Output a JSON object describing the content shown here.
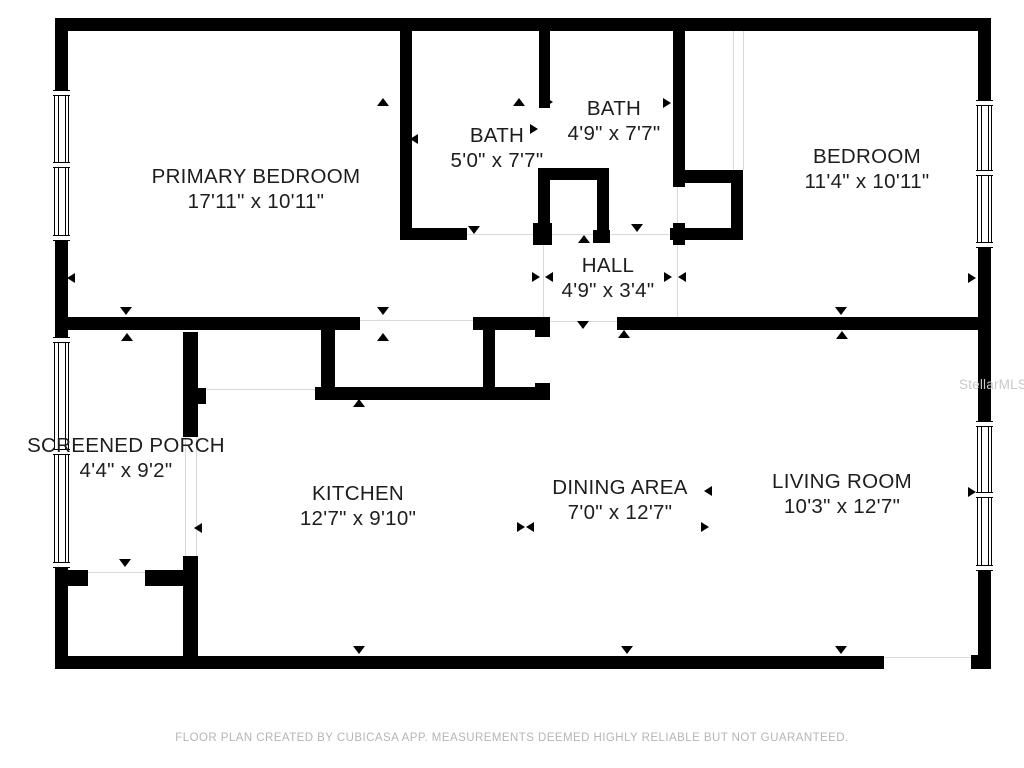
{
  "title": "Floor plan",
  "rooms": [
    {
      "name": "PRIMARY BEDROOM",
      "dims": "17'11\" x 10'11\"",
      "cx": 256,
      "cy": 189
    },
    {
      "name": "BATH",
      "dims": "5'0\" x 7'7\"",
      "cx": 497,
      "cy": 148
    },
    {
      "name": "BATH",
      "dims": "4'9\" x 7'7\"",
      "cx": 614,
      "cy": 121
    },
    {
      "name": "BEDROOM",
      "dims": "11'4\" x 10'11\"",
      "cx": 867,
      "cy": 169
    },
    {
      "name": "HALL",
      "dims": "4'9\" x 3'4\"",
      "cx": 608,
      "cy": 278
    },
    {
      "name": "SCREENED PORCH",
      "dims": "4'4\" x 9'2\"",
      "cx": 126,
      "cy": 458
    },
    {
      "name": "KITCHEN",
      "dims": "12'7\" x 9'10\"",
      "cx": 358,
      "cy": 506
    },
    {
      "name": "DINING AREA",
      "dims": "7'0\" x 12'7\"",
      "cx": 620,
      "cy": 500
    },
    {
      "name": "LIVING ROOM",
      "dims": "10'3\" x 12'7\"",
      "cx": 842,
      "cy": 494
    }
  ],
  "footer": {
    "text": "FLOOR PLAN CREATED BY CUBICASA APP. MEASUREMENTS DEEMED HIGHLY RELIABLE BUT NOT GUARANTEED."
  },
  "watermark": {
    "text": "StellarMLS"
  },
  "colors": {
    "wall": "#000000",
    "hairline": "#d9d9d9",
    "label": "#1d1d1d",
    "footer": "#b5b5b5",
    "watermark": "#c9c9c9",
    "background": "#ffffff"
  },
  "plan": {
    "walls": [
      [
        55,
        18,
        936,
        13
      ],
      [
        55,
        18,
        13,
        72
      ],
      [
        55,
        240,
        13,
        97
      ],
      [
        55,
        567,
        13,
        102
      ],
      [
        978,
        18,
        13,
        82
      ],
      [
        978,
        247,
        13,
        174
      ],
      [
        978,
        570,
        13,
        99
      ],
      [
        55,
        656,
        829,
        13
      ],
      [
        971,
        655,
        20,
        14
      ],
      [
        400,
        31,
        12,
        209
      ],
      [
        400,
        228,
        67,
        12
      ],
      [
        539,
        31,
        11,
        77
      ],
      [
        538,
        168,
        71,
        12
      ],
      [
        538,
        168,
        12,
        77
      ],
      [
        597,
        168,
        12,
        75
      ],
      [
        533,
        223,
        19,
        22
      ],
      [
        593,
        230,
        17,
        13
      ],
      [
        673,
        31,
        12,
        156
      ],
      [
        673,
        223,
        12,
        22
      ],
      [
        685,
        170,
        58,
        13
      ],
      [
        731,
        170,
        12,
        70
      ],
      [
        670,
        228,
        73,
        12
      ],
      [
        55,
        317,
        305,
        13
      ],
      [
        473,
        317,
        69,
        13
      ],
      [
        535,
        317,
        15,
        20
      ],
      [
        483,
        317,
        12,
        81
      ],
      [
        535,
        383,
        15,
        17
      ],
      [
        315,
        387,
        235,
        13
      ],
      [
        321,
        330,
        14,
        57
      ],
      [
        617,
        317,
        374,
        13
      ],
      [
        183,
        332,
        15,
        105
      ],
      [
        183,
        556,
        15,
        100
      ],
      [
        195,
        388,
        11,
        16
      ],
      [
        55,
        570,
        33,
        16
      ],
      [
        145,
        570,
        53,
        16
      ]
    ],
    "windows": [
      [
        54,
        90,
        15,
        150
      ],
      [
        54,
        337,
        15,
        230
      ],
      [
        977,
        100,
        15,
        147
      ],
      [
        977,
        421,
        15,
        149
      ]
    ],
    "hairlines": [
      [
        460,
        234,
        217,
        1
      ],
      [
        543,
        245,
        1,
        72
      ],
      [
        677,
        187,
        1,
        130
      ],
      [
        360,
        320,
        113,
        1
      ],
      [
        548,
        321,
        69,
        1
      ],
      [
        198,
        389,
        117,
        1
      ],
      [
        88,
        572,
        57,
        1
      ],
      [
        884,
        657,
        87,
        1
      ],
      [
        185,
        437,
        1,
        119
      ],
      [
        196,
        437,
        1,
        119
      ],
      [
        733,
        31,
        1,
        139
      ],
      [
        743,
        31,
        1,
        139
      ]
    ],
    "triangles": [
      {
        "x": 383,
        "y": 103,
        "dir": "up"
      },
      {
        "x": 519,
        "y": 103,
        "dir": "up"
      },
      {
        "x": 73,
        "y": 278,
        "dir": "left"
      },
      {
        "x": 416,
        "y": 139,
        "dir": "left"
      },
      {
        "x": 536,
        "y": 129,
        "dir": "right"
      },
      {
        "x": 551,
        "y": 102,
        "dir": "right"
      },
      {
        "x": 669,
        "y": 103,
        "dir": "right"
      },
      {
        "x": 474,
        "y": 231,
        "dir": "down"
      },
      {
        "x": 637,
        "y": 229,
        "dir": "down"
      },
      {
        "x": 584,
        "y": 240,
        "dir": "up"
      },
      {
        "x": 538,
        "y": 277,
        "dir": "right"
      },
      {
        "x": 551,
        "y": 277,
        "dir": "left"
      },
      {
        "x": 670,
        "y": 277,
        "dir": "right"
      },
      {
        "x": 684,
        "y": 277,
        "dir": "left"
      },
      {
        "x": 126,
        "y": 312,
        "dir": "down"
      },
      {
        "x": 127,
        "y": 338,
        "dir": "up"
      },
      {
        "x": 383,
        "y": 312,
        "dir": "down"
      },
      {
        "x": 383,
        "y": 338,
        "dir": "up"
      },
      {
        "x": 583,
        "y": 326,
        "dir": "down"
      },
      {
        "x": 624,
        "y": 335,
        "dir": "up"
      },
      {
        "x": 359,
        "y": 404,
        "dir": "up"
      },
      {
        "x": 200,
        "y": 528,
        "dir": "left"
      },
      {
        "x": 359,
        "y": 651,
        "dir": "down"
      },
      {
        "x": 523,
        "y": 527,
        "dir": "right"
      },
      {
        "x": 532,
        "y": 527,
        "dir": "left"
      },
      {
        "x": 710,
        "y": 491,
        "dir": "left"
      },
      {
        "x": 707,
        "y": 527,
        "dir": "right"
      },
      {
        "x": 627,
        "y": 651,
        "dir": "down"
      },
      {
        "x": 841,
        "y": 651,
        "dir": "down"
      },
      {
        "x": 841,
        "y": 312,
        "dir": "down"
      },
      {
        "x": 842,
        "y": 336,
        "dir": "up"
      },
      {
        "x": 974,
        "y": 278,
        "dir": "right"
      },
      {
        "x": 974,
        "y": 492,
        "dir": "right"
      },
      {
        "x": 125,
        "y": 564,
        "dir": "down"
      }
    ]
  }
}
